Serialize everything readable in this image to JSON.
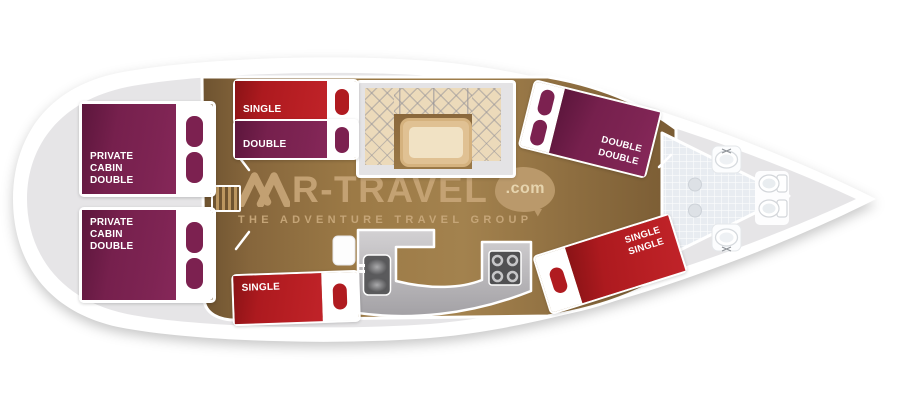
{
  "boat": {
    "beds": {
      "private_cabin_top": {
        "label": "PRIVATE\nCABIN\nDOUBLE"
      },
      "private_cabin_bottom": {
        "label": "PRIVATE\nCABIN\nDOUBLE"
      },
      "single_top": {
        "label": "SINGLE"
      },
      "double_mid": {
        "label": "DOUBLE"
      },
      "double_double_right": {
        "label": "DOUBLE\nDOUBLE"
      },
      "single_bottom": {
        "label": "SINGLE"
      },
      "single_single_right": {
        "label": "SINGLE\nSINGLE"
      }
    },
    "fixtures": {
      "saloon": [
        "u-settee",
        "table"
      ],
      "galley": [
        "sink",
        "stove",
        "fridge"
      ],
      "bathroom": [
        "washbasin",
        "washbasin",
        "toilet",
        "toilet",
        "drain",
        "drain"
      ],
      "stairs": "companionway-steps"
    },
    "colors": {
      "hull": "#ffffff",
      "deck": "#e6e5e7",
      "wood_floor": "#96743f",
      "bed_red": "#b21c21",
      "bed_maroon": "#7c2150",
      "settee": "#ecdaba",
      "table": "#f1e2c4",
      "counter": "#b9b7bb",
      "tiles": "#e8ecf1",
      "logo_tan": "#c7a577"
    }
  },
  "logo": {
    "brand_prefix": "M",
    "brand_rest": "R-TRAVEL",
    "tld": ".com",
    "tagline": "THE ADVENTURE TRAVEL GROUP"
  }
}
